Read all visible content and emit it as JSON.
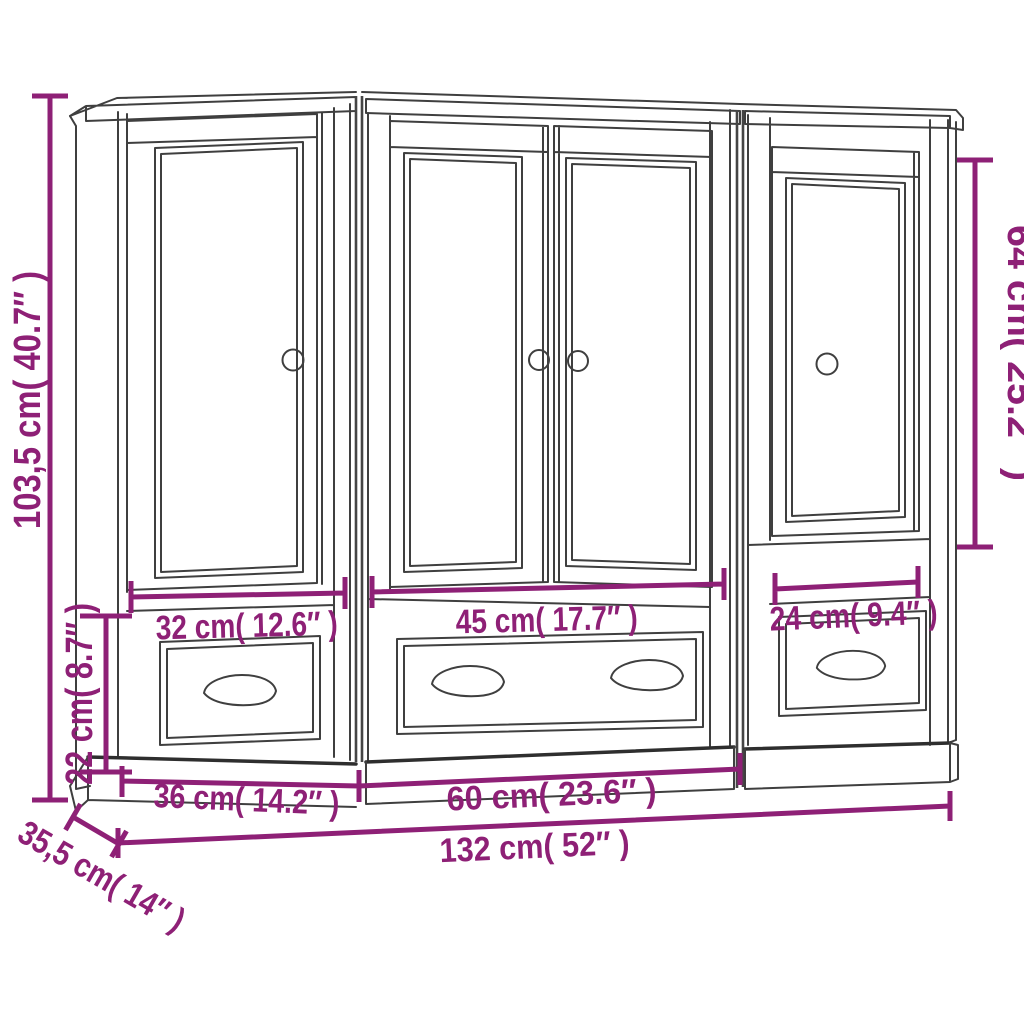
{
  "title": "3-piece highboard set dimension diagram",
  "colors": {
    "background": "#ffffff",
    "outline": "#3f3f3f",
    "dimension_accent": "#8e2076"
  },
  "furniture": {
    "units": [
      {
        "name": "left unit",
        "doors": 1,
        "drawers": 1
      },
      {
        "name": "middle unit",
        "doors": 2,
        "drawers": 1
      },
      {
        "name": "right unit",
        "doors": 1,
        "drawers": 1
      }
    ]
  },
  "dimensions": {
    "total_height": "103,5 cm( 40.7″ )",
    "base_height": "22 cm( 8.7″ )",
    "right_door_height": "64 cm( 25.2″ )",
    "left_door_width": "32 cm( 12.6″ )",
    "middle_door_width": "45 cm( 17.7″ )",
    "right_door_width": "24 cm( 9.4″ )",
    "left_unit_width": "36 cm( 14.2″ )",
    "middle_unit_width": "60 cm( 23.6″ )",
    "total_width": "132 cm( 52″ )",
    "depth": "35,5 cm( 14″ )"
  }
}
